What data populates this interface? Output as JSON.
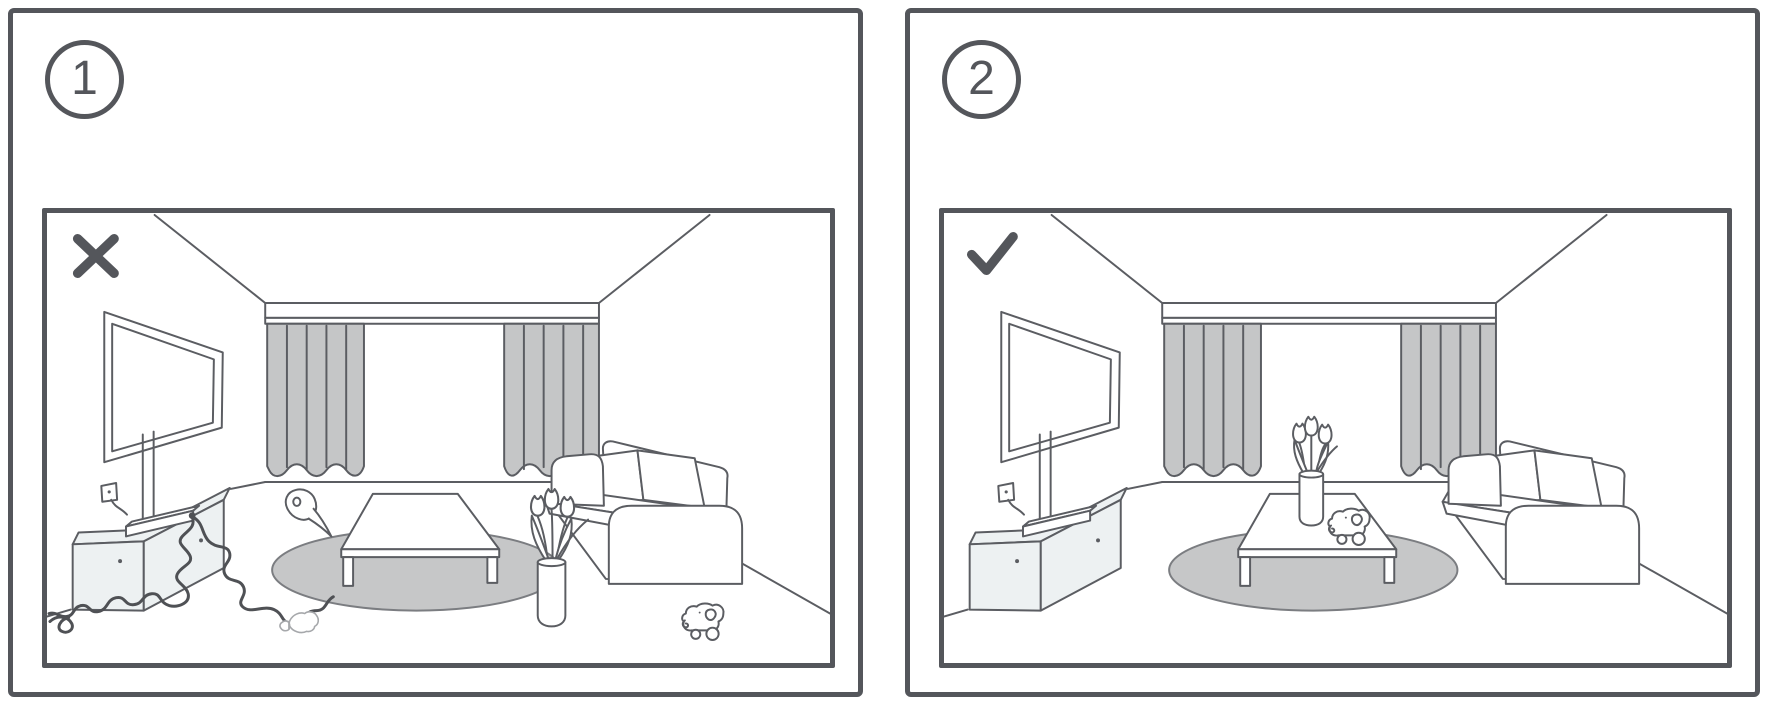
{
  "figure": {
    "kind": "instructional-diagram",
    "topic": "living-room setup comparison: cluttered (incorrect) vs tidy (correct)"
  },
  "colors": {
    "panel_border": "#54565B",
    "scene_line": "#5B5D62",
    "scene_line_light": "#A6A8AB",
    "curtain_fill": "#C5C6C7",
    "rug_fill": "#C6C7C8",
    "rug_outline": "#7B7D81",
    "cabinet_fill": "#EDF1F2",
    "cable": "#4F5155",
    "mark": "#54565B",
    "paper": "#FFFFFF"
  },
  "panels": [
    {
      "badge_label": "1",
      "mark": "cross",
      "scene_items": [
        "picture-frame",
        "curtained-window",
        "wall-outlet",
        "tv-cabinet",
        "wifi-router",
        "round-rug",
        "coffee-table",
        "sofa",
        "tangled-cables",
        "toilet-paper-roll",
        "plastic-bottle",
        "flower-vase-on-floor",
        "toy-elephant-on-floor"
      ]
    },
    {
      "badge_label": "2",
      "mark": "check",
      "scene_items": [
        "picture-frame",
        "curtained-window",
        "wall-outlet",
        "tv-cabinet",
        "wifi-router",
        "round-rug",
        "coffee-table",
        "sofa",
        "flower-vase-on-table",
        "toy-elephant-on-table"
      ]
    }
  ]
}
